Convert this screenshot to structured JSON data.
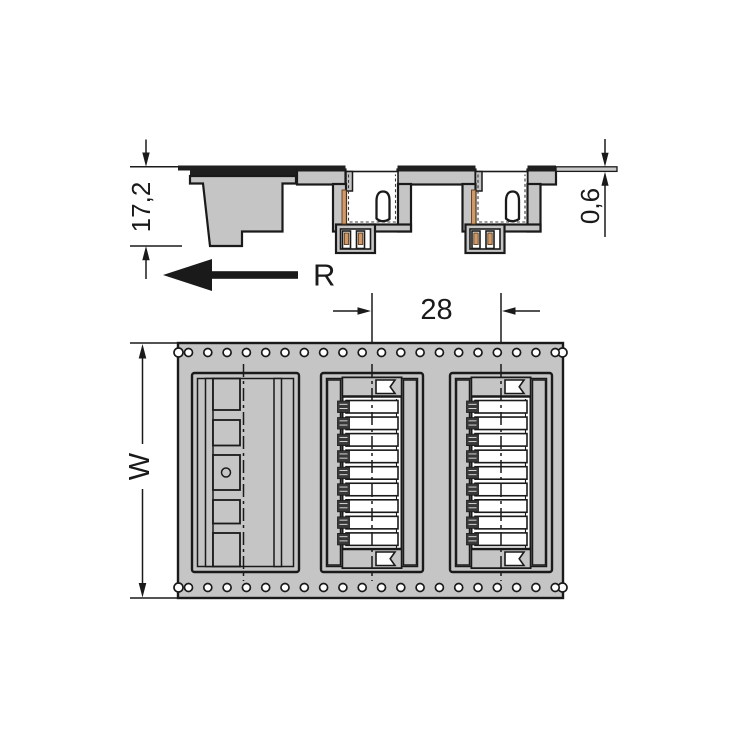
{
  "labels": {
    "component_height": "17,2",
    "tape_thickness": "0,6",
    "reel_direction": "R",
    "pocket_pitch": "28",
    "tape_width": "W"
  },
  "colors": {
    "background": "#ffffff",
    "fill_gray": "#c5c5c5",
    "line_dark": "#1a1a1a",
    "bar_dark": "#1f1f1f",
    "contact_orange": "#d09a68",
    "tape_thin": "#c9c9c9"
  },
  "sprockets": {
    "rows": 2,
    "holes_per_row": 20,
    "start_x": 188.5,
    "pitch": 19.3,
    "top_y": 352.5,
    "bottom_y": 587.5,
    "radius": 4
  }
}
